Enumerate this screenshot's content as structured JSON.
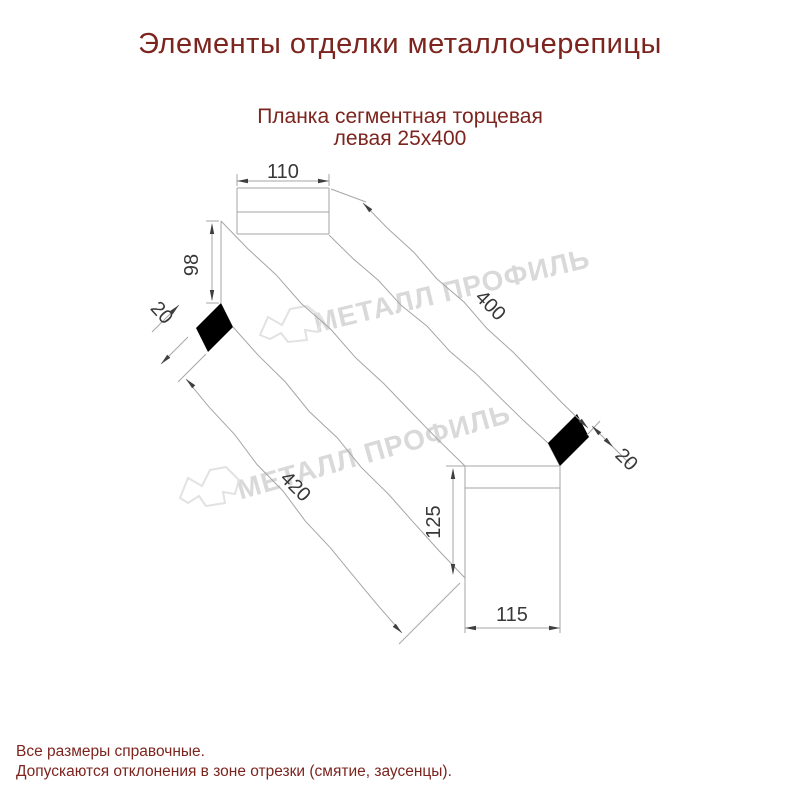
{
  "title": "Элементы отделки металлочерепицы",
  "subtitle": {
    "line1": "Планка сегментная торцевая",
    "line2": "левая 25х400"
  },
  "watermark": {
    "text": "МЕТАЛЛ ПРОФИЛЬ",
    "logo_icon": "metal-profil-bird-logo"
  },
  "dimensions": {
    "top_width": "110",
    "far_height": "98",
    "left_hem": "20",
    "length_top": "400",
    "length_bottom": "420",
    "near_height": "125",
    "near_width": "115",
    "right_hem": "20"
  },
  "footer": {
    "line1": "Все размеры справочные.",
    "line2": "Допускаются отклонения в зоне отрезки (смятие, заусенцы)."
  },
  "colors": {
    "heading": "#7c241e",
    "dimension_text": "#383838",
    "drawing_line": "#a6a6a6",
    "arrow": "#3f3f3f",
    "watermark": "#d9d9d9",
    "logo_outline": "#e2e2e2"
  }
}
